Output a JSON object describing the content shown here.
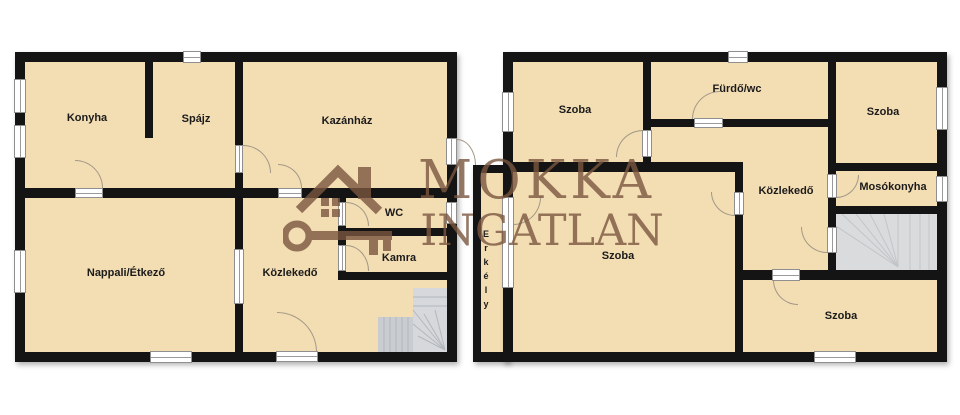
{
  "agency_watermark": {
    "title": "MOKKA",
    "subtitle": "INGATLAN",
    "logo": "house-and-key",
    "color": "#7a573f"
  },
  "palette": {
    "background": "#ffffff",
    "room_fill": "#f3ddb3",
    "wall": "#141414",
    "opening_frame": "#8f8f8f",
    "door_arc": "#a39887",
    "stairs_fill": "#d7d9db",
    "stairs_line": "#c0c3c6",
    "label_color": "#1b1b1b"
  },
  "floor_left": {
    "rooms": {
      "konyha": "Konyha",
      "spajz": "Spájz",
      "kazanhaz": "Kazánház",
      "nappali": "Nappali/Étkező",
      "kozlekedo": "Közlekedő",
      "wc": "WC",
      "kamra": "Kamra"
    }
  },
  "floor_right": {
    "rooms": {
      "szoba_tl": "Szoba",
      "furdo": "Fürdő/wc",
      "szoba_tr": "Szoba",
      "kozlekedo": "Közlekedő",
      "mosokonyha": "Mosókonyha",
      "szoba_big": "Szoba",
      "szoba_br": "Szoba",
      "erkely": "Erkély"
    }
  }
}
